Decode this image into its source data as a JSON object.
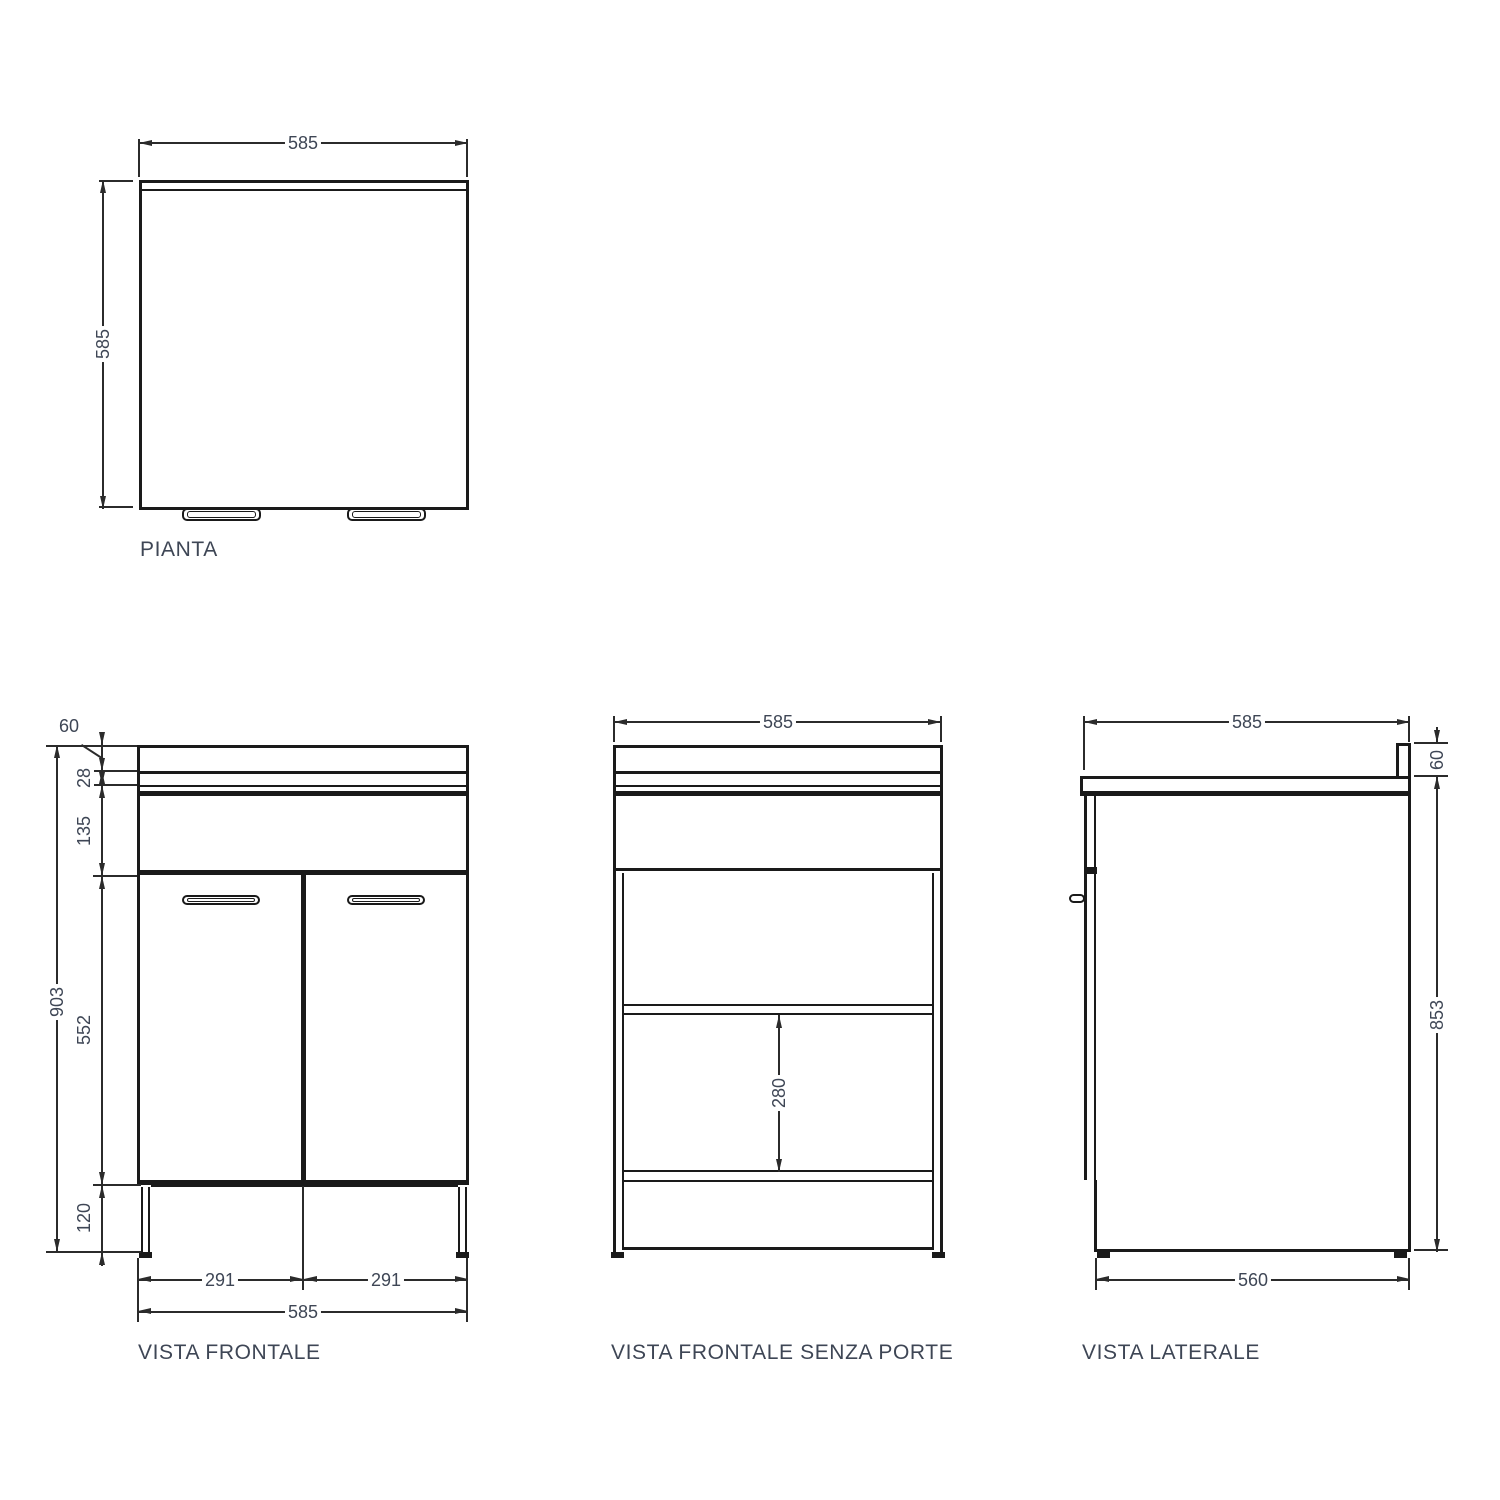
{
  "colors": {
    "line": "#1a1a1a",
    "dimension_line": "#2b2b2b",
    "text": "#3e4655",
    "background": "#ffffff"
  },
  "plan": {
    "label": "PIANTA",
    "dim_width": "585",
    "dim_depth": "585"
  },
  "front": {
    "label": "VISTA FRONTALE",
    "dim_top": "60",
    "dim_gap": "28",
    "dim_drawer": "135",
    "dim_height_total": "903",
    "dim_doors": "552",
    "dim_plinth": "120",
    "dim_door_left": "291",
    "dim_door_right": "291",
    "dim_width": "585"
  },
  "front_open": {
    "label": "VISTA FRONTALE SENZA PORTE",
    "dim_width": "585",
    "dim_shelf_gap": "280"
  },
  "side": {
    "label": "VISTA LATERALE",
    "dim_width": "585",
    "dim_top": "60",
    "dim_height": "853",
    "dim_depth": "560"
  }
}
